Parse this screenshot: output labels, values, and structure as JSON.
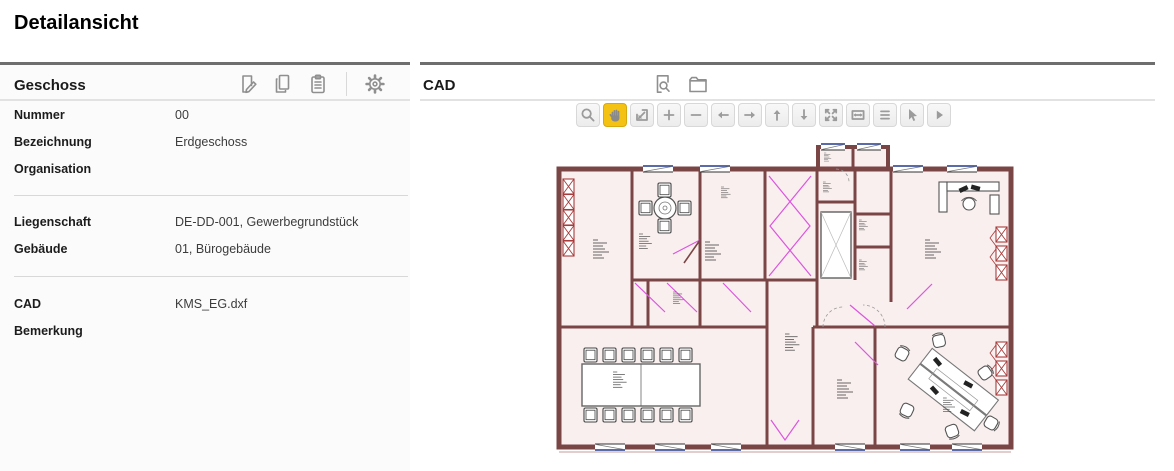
{
  "page": {
    "title": "Detailansicht"
  },
  "geschoss_panel": {
    "title": "Geschoss",
    "toolbar": [
      {
        "id": "edit",
        "icon": "edit-document-icon"
      },
      {
        "id": "copy",
        "icon": "copy-icon"
      },
      {
        "id": "clipboard",
        "icon": "clipboard-icon"
      },
      {
        "id": "settings",
        "icon": "gear-icon"
      }
    ],
    "fields": [
      {
        "label": "Nummer",
        "value": "00"
      },
      {
        "label": "Bezeichnung",
        "value": "Erdgeschoss"
      },
      {
        "label": "Organisation",
        "value": ""
      },
      {
        "label": "Liegenschaft",
        "value": "DE-DD-001, Gewerbegrundstück"
      },
      {
        "label": "Gebäude",
        "value": "01, Bürogebäude"
      },
      {
        "label": "CAD",
        "value": "KMS_EG.dxf"
      },
      {
        "label": "Bemerkung",
        "value": ""
      }
    ]
  },
  "cad_panel": {
    "title": "CAD",
    "header_icons": [
      {
        "id": "preview",
        "icon": "document-search-icon"
      },
      {
        "id": "open",
        "icon": "folder-icon"
      }
    ],
    "viewer_toolbar": {
      "active_tool": "pan",
      "active_color": "#f3c212",
      "buttons": [
        {
          "id": "zoom",
          "icon": "magnifier-icon",
          "active": false
        },
        {
          "id": "pan",
          "icon": "hand-icon",
          "active": true
        },
        {
          "id": "zoom-window",
          "icon": "zoom-window-icon",
          "active": false
        },
        {
          "id": "zoom-in",
          "icon": "plus-icon",
          "active": false
        },
        {
          "id": "zoom-out",
          "icon": "minus-icon",
          "active": false
        },
        {
          "id": "pan-left",
          "icon": "arrow-left-icon",
          "active": false
        },
        {
          "id": "pan-right",
          "icon": "arrow-right-icon",
          "active": false
        },
        {
          "id": "pan-up",
          "icon": "arrow-up-icon",
          "active": false
        },
        {
          "id": "pan-down",
          "icon": "arrow-down-icon",
          "active": false
        },
        {
          "id": "fit-view",
          "icon": "expand-icon",
          "active": false
        },
        {
          "id": "fit-width",
          "icon": "fit-width-icon",
          "active": false
        },
        {
          "id": "layers",
          "icon": "list-icon",
          "active": false
        },
        {
          "id": "select",
          "icon": "pointer-icon",
          "active": false
        },
        {
          "id": "more",
          "icon": "play-icon",
          "active": false
        }
      ]
    },
    "drawing": {
      "type": "floor-plan",
      "colors": {
        "wall": "#7a4545",
        "floor": "#f9efef",
        "door_swing": "#dd55dd",
        "radiator": "#a83c3c",
        "window_accent": "#223a8c"
      }
    }
  }
}
